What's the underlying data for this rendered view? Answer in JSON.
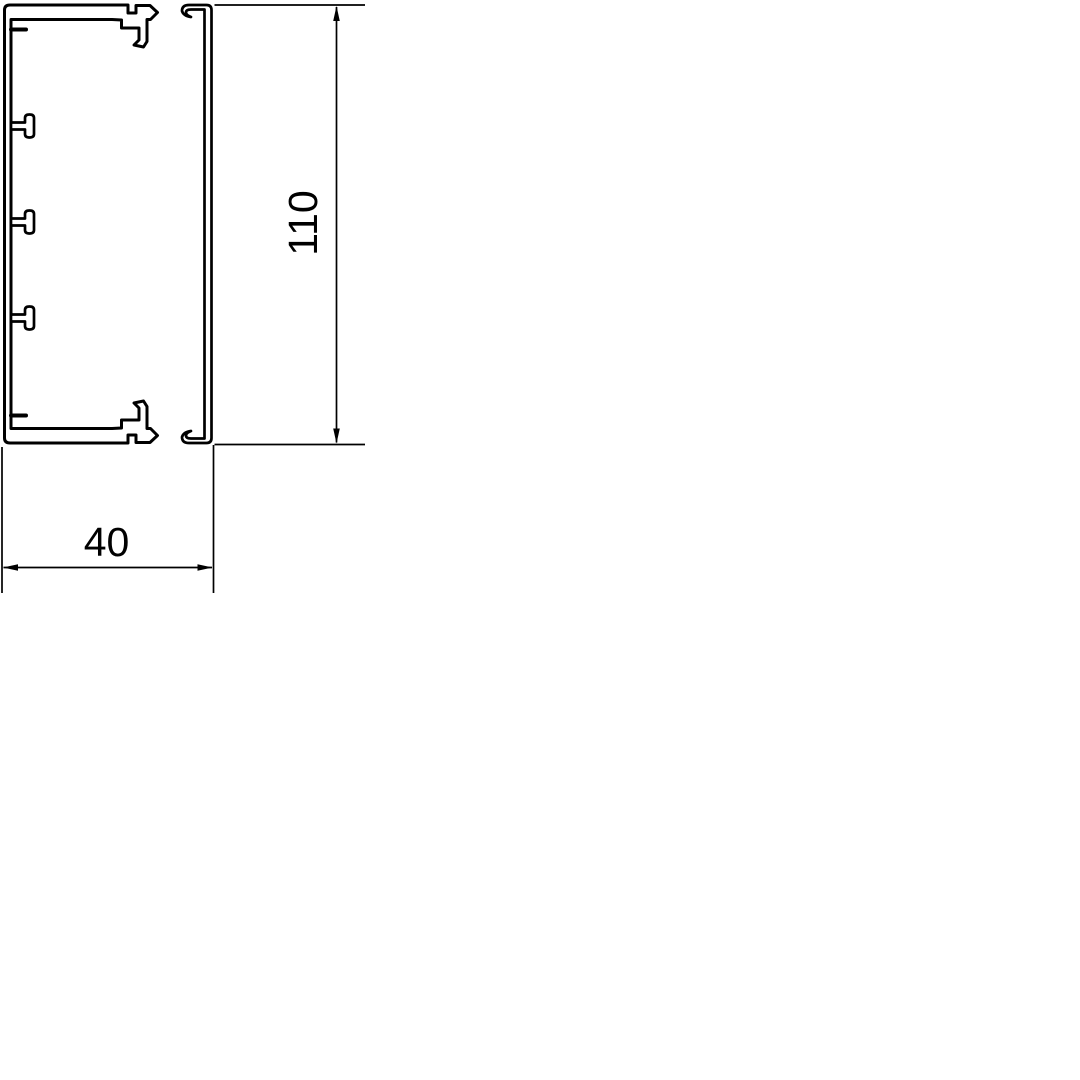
{
  "drawing": {
    "dimensions": {
      "height": "110",
      "width": "40"
    },
    "colors": {
      "line": "#000000",
      "background": "#ffffff"
    }
  }
}
